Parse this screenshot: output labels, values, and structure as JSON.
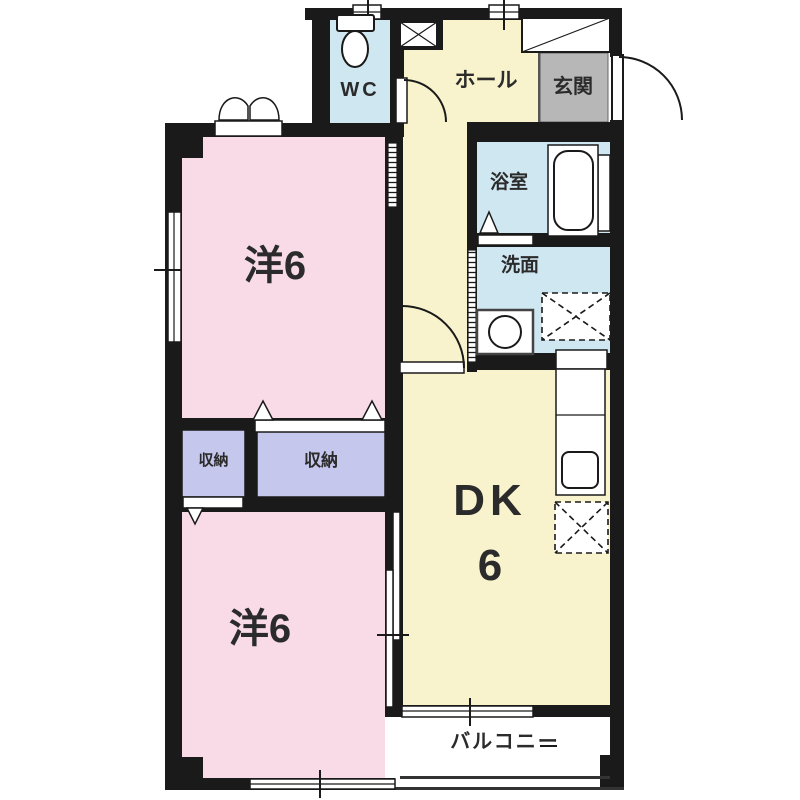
{
  "rooms": {
    "wc": {
      "label": "WC"
    },
    "hall": {
      "label": "ホール"
    },
    "entrance": {
      "label": "玄関"
    },
    "bathroom": {
      "label": "浴室"
    },
    "washroom": {
      "label": "洗面"
    },
    "storage_small": {
      "label": "収納"
    },
    "storage_large": {
      "label": "収納"
    },
    "western_room_upper": {
      "label": "洋6"
    },
    "western_room_lower": {
      "label": "洋6"
    },
    "dining_kitchen": {
      "label": "DK",
      "size": "6"
    },
    "balcony": {
      "label": "バルコニー"
    }
  },
  "colors": {
    "pink": "#f8dbe7",
    "cream": "#f8f3cd",
    "blue": "#cfe7f1",
    "lavender": "#c6c7ed",
    "gray": "#b7b7b7",
    "wall": "#1a1a1a"
  },
  "fixtures": {
    "toilet": "ellipse-bowl-with-tank",
    "bathtub": "rounded-rect-tub",
    "washing-machine": "circle-in-square",
    "equipment-space": "dashed-box-with-x",
    "refrigerator-space": "dashed-box-with-x",
    "kitchen-sink": "rounded-square",
    "kitchen-counter": "white-strip",
    "shoe-cabinet": "box-with-diagonal",
    "pipe-space": "box-with-x",
    "doors": "quarter-arc-swing, sliding-hatch, folding-triangle"
  }
}
